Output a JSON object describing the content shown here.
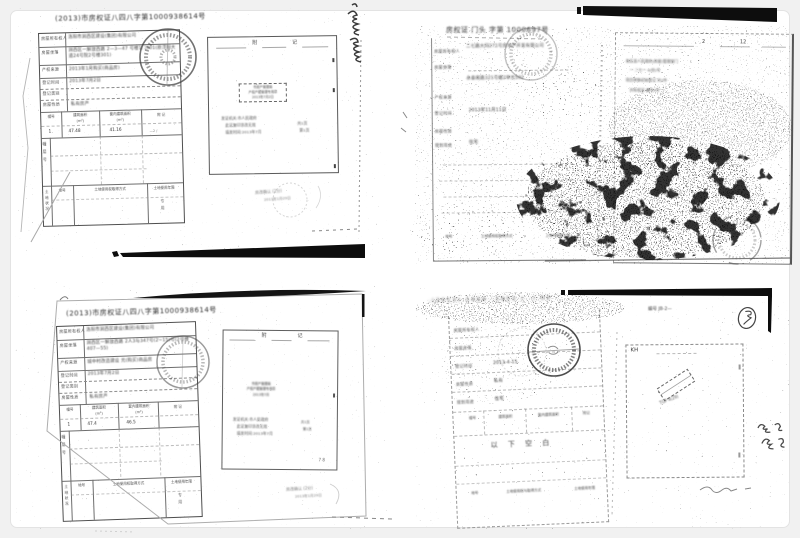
{
  "page": {
    "background": "#f1f1f1",
    "card_background": "#ffffff",
    "card_border": "#e3e3e3",
    "ink": "#3a3a3a",
    "bar_black": "#0d0d0d"
  },
  "unit_label": "(m²)",
  "top_left": {
    "title": "(2013)市房权证八四八字第1000938614号",
    "form_rows": [
      {
        "label": "房屋所有权人",
        "value": "洛阳市涧西区建设(集团)有限公司"
      },
      {
        "label": "房屋坐落",
        "value": "涧西区一解放西路 2—3—47 号楼1门301(原浮阳大道24号院2号楼301)"
      },
      {
        "label": "产权来源",
        "value": "2013年1月购买(商品房)"
      },
      {
        "label": "登记时间",
        "value": "2013年7月2日"
      },
      {
        "label": "登记类别",
        "value": ""
      },
      {
        "label": "房屋性质",
        "value": "私有房产"
      }
    ],
    "table_headers": [
      "幢号",
      "建筑面积",
      "套内建筑面积",
      "附 记"
    ],
    "table_row": [
      "1",
      "47.48",
      "41.16",
      "—2 /"
    ],
    "section_side_label": "幢层号",
    "land_side_label": "土地状况",
    "land_headers": [
      "地号",
      "土地使用权取得方式",
      "土地使用年限"
    ],
    "land_note": "专用",
    "annex": {
      "header_left": "附",
      "header_right": "记",
      "stamp_box_lines": [
        "市房产管理局",
        "产权产籍管理专用章",
        "2013年7月2日"
      ],
      "note_lines": [
        "发证机关:市人民政府",
        "此证复印涂改无效",
        "填发时间:2013年7月"
      ],
      "side_lines": [
        "共1页",
        "第1页"
      ]
    },
    "footer_stamp_lines": [
      "房改确认 (2分)",
      "2013年1月29日"
    ]
  },
  "top_right": {
    "title": "房权证 门头 字第 1000697号",
    "form_rows": [
      {
        "label": "房屋所有权人",
        "value": "二七路大同271号房地产开发有限公司"
      },
      {
        "label": "房屋坐落",
        "value": "永泰南路321号楼2单元502"
      },
      {
        "label": "产权来源",
        "value": ""
      },
      {
        "label": "登记时间",
        "value": "2013年11月11日"
      },
      {
        "label": "房屋性质",
        "value": ""
      },
      {
        "label": "规划用途",
        "value": "住宅"
      }
    ],
    "page_numbers": [
      "2",
      "12"
    ],
    "annex_lines": [
      "各区县人民政府(房屋)管理部门",
      "一 二七一 4(份)号",
      "项目转移初始登记 共2件",
      "共有权证 编号4号"
    ],
    "bottom_row": [
      "地号",
      "土地使用权取得方式",
      "上海市房屋土地"
    ]
  },
  "bottom_left": {
    "title": "(2013)市房权证八四八字第1000938614号",
    "form_rows": [
      {
        "label": "房屋所有权人",
        "value": "洛阳市涧西区建设(集团)有限公司"
      },
      {
        "label": "房屋坐落",
        "value": "涧西区一解放西路 2人3与347号(2~15)号(2号楼407—55)"
      },
      {
        "label": "产权来源",
        "value": "城中村改造建设 元(购买)商品房"
      },
      {
        "label": "登记时间",
        "value": "2013年7月2日"
      },
      {
        "label": "登记类别",
        "value": ""
      },
      {
        "label": "房屋性质",
        "value": "私有房产"
      }
    ],
    "table_headers": [
      "幢号",
      "建筑面积",
      "套内建筑面积",
      "附 记"
    ],
    "table_row": [
      "1",
      "47.4",
      "46.5",
      ""
    ],
    "section_side_label": "幢层号",
    "land_side_label": "土地状况",
    "land_headers": [
      "地号",
      "土地使用权取得方式",
      "土地使用年限"
    ],
    "land_note": "专用",
    "annex": {
      "header_left": "附",
      "header_right": "记",
      "stamp_box_lines": [
        "市房产管理局",
        "产权产籍管理专用章",
        "2013年7月"
      ],
      "note_lines": [
        "发证机关:市人民政府",
        "此证复印涂改无效",
        "填发时间:2013年7月"
      ],
      "side_lines": [
        "共1页",
        "第1页"
      ],
      "corner_note": "7 8"
    },
    "footer_stamp_lines": [
      "房改确认 (2分)",
      "2013年1月29日"
    ]
  },
  "bottom_right": {
    "header_smudge": "·(2013)·1456·:1953·(··)·53",
    "doc_number": "编号 JB-2—",
    "form_rows": [
      {
        "label": "房屋所有权人",
        "value": ""
      },
      {
        "label": "房屋坐落",
        "value": ""
      },
      {
        "label": "登记时间",
        "value": "2013-4-15"
      },
      {
        "label": "房屋性质",
        "value": "私有"
      },
      {
        "label": "规划用途",
        "value": "住宅"
      }
    ],
    "table_headers": [
      "幢号",
      "建筑面积",
      "套内建筑面积",
      "附记"
    ],
    "blank_note": "以 下 空 白",
    "bottom_row": [
      "地号",
      "土地使用权与取得方式",
      "土地使用年限"
    ],
    "annex_label": "KH",
    "diag_stamp_text": "TGP 4(29)"
  }
}
